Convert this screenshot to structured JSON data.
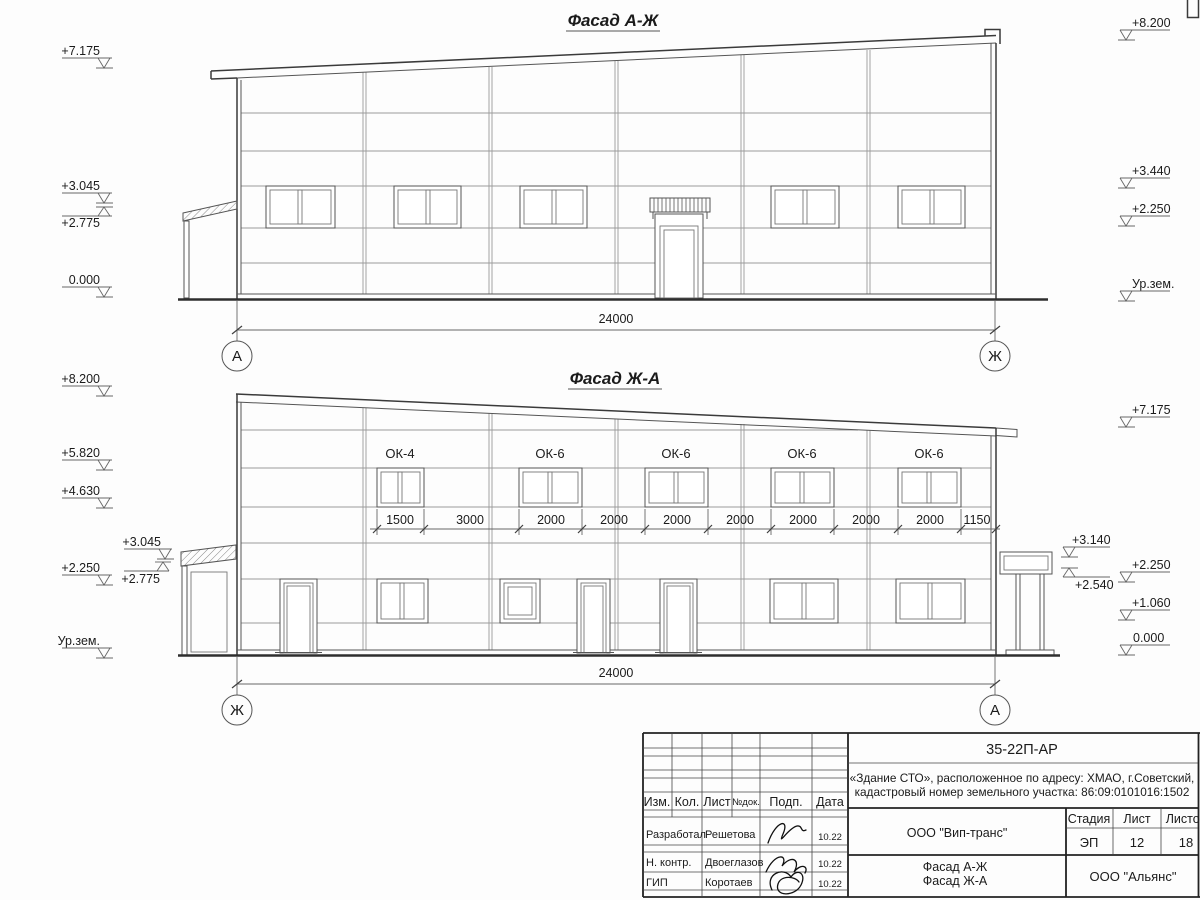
{
  "drawing": {
    "facade_top": {
      "title": "Фасад А-Ж",
      "left_marks": [
        "+7.175",
        "+3.045",
        "+2.775",
        "0.000"
      ],
      "right_marks": [
        "+8.200",
        "+3.440",
        "+2.250",
        "Ур.зем."
      ],
      "dim_total": "24000",
      "axis_left": "А",
      "axis_right": "Ж"
    },
    "facade_bottom": {
      "title": "Фасад Ж-А",
      "left_marks": [
        "+8.200",
        "+5.820",
        "+4.630",
        "+3.045",
        "+2.250",
        "+2.775",
        "Ур.зем."
      ],
      "right_marks": [
        "+7.175",
        "+3.140",
        "+2.250",
        "+2.540",
        "+1.060",
        "0.000"
      ],
      "window_labels": [
        "ОК-4",
        "ОК-6",
        "ОК-6",
        "ОК-6",
        "ОК-6"
      ],
      "window_dims": [
        "1500",
        "3000",
        "2000",
        "2000",
        "2000",
        "2000",
        "2000",
        "2000",
        "2000",
        "1150"
      ],
      "dim_total": "24000",
      "axis_left": "Ж",
      "axis_right": "А"
    }
  },
  "title_block": {
    "doc_number": "35-22П-АР",
    "project_line1": "«Здание СТО», расположенное по адресу: ХМАО, г.Советский,",
    "project_line2": "кадастровый номер земельного участка: 86:09:0101016:1502",
    "columns": {
      "izm": "Изм.",
      "kol": "Кол.",
      "list": "Лист",
      "ndoc": "№док.",
      "podp": "Подп.",
      "data": "Дата"
    },
    "rows": [
      {
        "role": "Разработал",
        "name": "Решетова",
        "date": "10.22"
      },
      {
        "role": "Н. контр.",
        "name": "Двоеглазов",
        "date": "10.22"
      },
      {
        "role": "ГИП",
        "name": "Коротаев",
        "date": "10.22"
      }
    ],
    "company": "ООО \"Вип-транс\"",
    "stage_label": "Стадия",
    "sheet_label": "Лист",
    "sheets_label": "Листов",
    "stage": "ЭП",
    "sheet": "12",
    "sheets": "18",
    "content_line1": "Фасад А-Ж",
    "content_line2": "Фасад Ж-А",
    "company2": "ООО \"Альянс\""
  }
}
